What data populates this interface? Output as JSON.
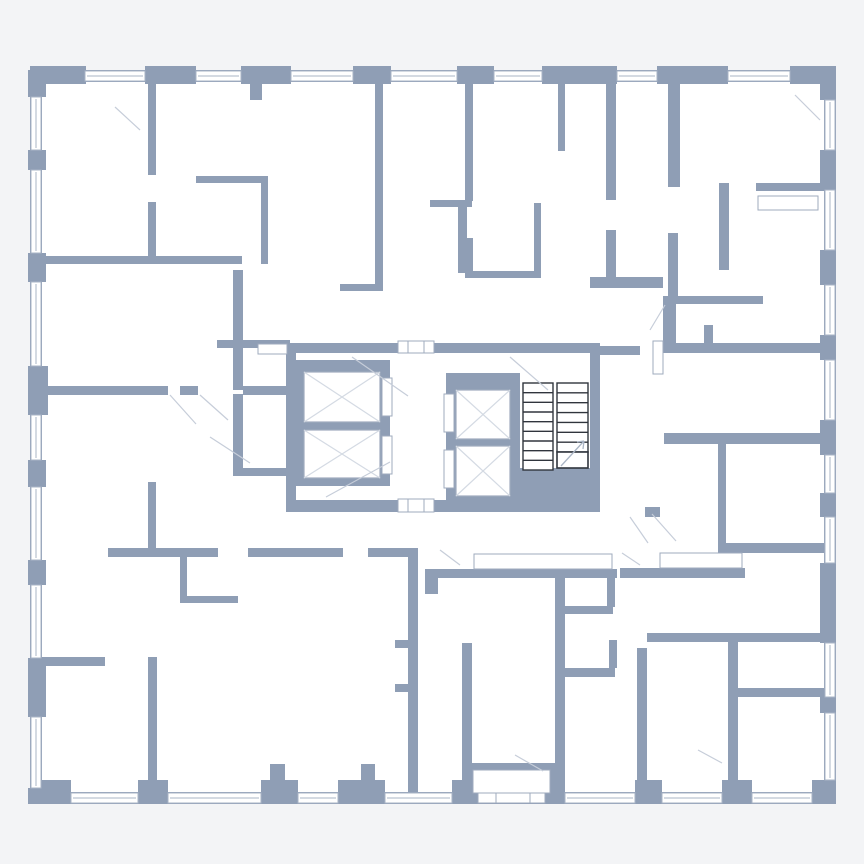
{
  "plan": {
    "canvas": {
      "w": 864,
      "h": 864
    },
    "colors": {
      "background": "#f3f4f6",
      "strip": "#ffffff",
      "wall": "#8f9eb5",
      "floor": "#ffffff",
      "window_line": "#a9b4c6",
      "box_line": "#9fabbe",
      "swing_line": "#c6cdd9",
      "elevator_x_line": "#d4dae3",
      "stair_outline": "#30353d",
      "arrow_line": "#aab5c5"
    },
    "floor": {
      "x": 30,
      "y": 70,
      "w": 806,
      "h": 734
    },
    "walls": [
      [
        "outer-wall-top",
        30,
        70,
        806,
        12
      ],
      [
        "outer-wall-bottom",
        30,
        792,
        806,
        12
      ],
      [
        "outer-wall-left",
        30,
        70,
        12,
        734
      ],
      [
        "outer-wall-right",
        824,
        70,
        12,
        734
      ],
      [
        "pier-top-0",
        30,
        66,
        56,
        18
      ],
      [
        "pier-top-1",
        145,
        66,
        51,
        18
      ],
      [
        "pier-top-2",
        241,
        66,
        50,
        18
      ],
      [
        "pier-top-3",
        353,
        66,
        38,
        18
      ],
      [
        "pier-top-4",
        457,
        66,
        37,
        18
      ],
      [
        "pier-top-5",
        542,
        66,
        75,
        18
      ],
      [
        "pier-top-6",
        657,
        66,
        71,
        18
      ],
      [
        "pier-top-7",
        790,
        66,
        46,
        18
      ],
      [
        "pier-bottom-0",
        30,
        780,
        41,
        24
      ],
      [
        "pier-bottom-1",
        138,
        780,
        30,
        24
      ],
      [
        "pier-bottom-2",
        261,
        780,
        37,
        24
      ],
      [
        "pier-bottom-3",
        338,
        780,
        47,
        24
      ],
      [
        "pier-bottom-4",
        452,
        780,
        16,
        24
      ],
      [
        "pier-bottom-5",
        635,
        780,
        27,
        24
      ],
      [
        "pier-bottom-6",
        722,
        780,
        30,
        24
      ],
      [
        "pier-bottom-7",
        812,
        780,
        24,
        24
      ],
      [
        "pier-left-0",
        28,
        70,
        18,
        27
      ],
      [
        "pier-left-1",
        28,
        150,
        18,
        20
      ],
      [
        "pier-left-2",
        28,
        253,
        18,
        29
      ],
      [
        "pier-left-3",
        28,
        366,
        20,
        49
      ],
      [
        "pier-left-4",
        28,
        460,
        18,
        27
      ],
      [
        "pier-left-5",
        28,
        560,
        18,
        25
      ],
      [
        "pier-left-6",
        28,
        658,
        18,
        59
      ],
      [
        "pier-left-7",
        28,
        788,
        18,
        16
      ],
      [
        "pier-right-0",
        820,
        70,
        16,
        30
      ],
      [
        "pier-right-1",
        820,
        150,
        16,
        40
      ],
      [
        "pier-right-2",
        820,
        250,
        16,
        35
      ],
      [
        "pier-right-3",
        820,
        335,
        16,
        25
      ],
      [
        "pier-right-4",
        820,
        420,
        16,
        35
      ],
      [
        "pier-right-5",
        820,
        493,
        16,
        24
      ],
      [
        "pier-right-6",
        820,
        563,
        16,
        80
      ],
      [
        "pier-right-7",
        820,
        697,
        16,
        16
      ],
      [
        "pier-right-8",
        820,
        780,
        16,
        24
      ],
      [
        "core-wall-top-left",
        286,
        343,
        112,
        10
      ],
      [
        "core-wall-top-right",
        434,
        343,
        166,
        10
      ],
      [
        "core-wall-left",
        286,
        343,
        10,
        169
      ],
      [
        "core-wall-right",
        590,
        343,
        10,
        169
      ],
      [
        "core-wall-bottom-left",
        286,
        500,
        112,
        12
      ],
      [
        "core-wall-bottom-right",
        434,
        500,
        166,
        12
      ],
      [
        "elevator-shaft-left",
        294,
        360,
        96,
        126
      ],
      [
        "elevator-shaft-small",
        446,
        373,
        74,
        131
      ],
      [
        "stair-landing",
        520,
        468,
        80,
        44
      ],
      [
        "wall-a1",
        148,
        83,
        8,
        92
      ],
      [
        "wall-a2",
        148,
        202,
        8,
        62
      ],
      [
        "wall-a3",
        42,
        256,
        200,
        8
      ],
      [
        "wall-a4",
        196,
        176,
        72,
        7
      ],
      [
        "wall-a5",
        261,
        176,
        7,
        88
      ],
      [
        "wall-a6",
        375,
        83,
        8,
        207
      ],
      [
        "wall-a7",
        340,
        284,
        43,
        7
      ],
      [
        "wall-b1",
        465,
        83,
        8,
        118
      ],
      [
        "wall-b2",
        465,
        238,
        8,
        40
      ],
      [
        "wall-b3",
        430,
        200,
        42,
        7
      ],
      [
        "wall-b4",
        458,
        207,
        9,
        66
      ],
      [
        "wall-b5",
        465,
        271,
        76,
        7
      ],
      [
        "wall-b6",
        534,
        203,
        7,
        75
      ],
      [
        "wall-b7",
        558,
        83,
        7,
        68
      ],
      [
        "wall-c1",
        606,
        80,
        10,
        120
      ],
      [
        "wall-c2",
        606,
        230,
        10,
        47
      ],
      [
        "wall-c3",
        590,
        277,
        73,
        11
      ],
      [
        "wall-c4",
        668,
        83,
        12,
        104
      ],
      [
        "wall-c5",
        756,
        183,
        68,
        8
      ],
      [
        "wall-c6",
        719,
        183,
        10,
        87
      ],
      [
        "wall-c7",
        668,
        233,
        10,
        70
      ],
      [
        "wall-c8",
        663,
        296,
        13,
        54
      ],
      [
        "wall-c9",
        663,
        296,
        100,
        8
      ],
      [
        "wall-d1",
        600,
        346,
        40,
        9
      ],
      [
        "wall-d2",
        663,
        343,
        161,
        10
      ],
      [
        "wall-d3",
        704,
        325,
        9,
        20
      ],
      [
        "wall-d4",
        664,
        433,
        160,
        11
      ],
      [
        "wall-d5",
        718,
        444,
        8,
        99
      ],
      [
        "wall-d6",
        718,
        543,
        106,
        10
      ],
      [
        "wall-d7",
        620,
        568,
        125,
        10
      ],
      [
        "wall-d8",
        647,
        633,
        177,
        9
      ],
      [
        "wall-d9",
        637,
        648,
        10,
        145
      ],
      [
        "wall-d10",
        728,
        642,
        10,
        151
      ],
      [
        "wall-d11",
        732,
        688,
        92,
        9
      ],
      [
        "wall-e1",
        42,
        386,
        126,
        9
      ],
      [
        "wall-e2",
        180,
        386,
        18,
        9
      ],
      [
        "wall-e3",
        243,
        386,
        45,
        9
      ],
      [
        "wall-e4",
        217,
        340,
        73,
        8
      ],
      [
        "wall-e5",
        233,
        270,
        10,
        120
      ],
      [
        "wall-e6",
        233,
        394,
        10,
        74
      ],
      [
        "wall-e7",
        233,
        468,
        70,
        8
      ],
      [
        "wall-f1",
        42,
        657,
        63,
        9
      ],
      [
        "wall-f2",
        148,
        657,
        9,
        135
      ],
      [
        "wall-f3",
        148,
        482,
        8,
        66
      ],
      [
        "wall-f4",
        180,
        557,
        7,
        46
      ],
      [
        "wall-f5",
        180,
        596,
        58,
        7
      ],
      [
        "wall-g1",
        108,
        548,
        110,
        9
      ],
      [
        "wall-g2",
        248,
        548,
        95,
        9
      ],
      [
        "wall-g3",
        368,
        548,
        40,
        9
      ],
      [
        "wall-g4",
        408,
        548,
        10,
        245
      ],
      [
        "wall-g5",
        425,
        569,
        192,
        9
      ],
      [
        "wall-g6",
        425,
        569,
        13,
        25
      ],
      [
        "wall-g7",
        462,
        643,
        10,
        150
      ],
      [
        "wall-g8",
        555,
        577,
        10,
        216
      ],
      [
        "wall-h1",
        560,
        606,
        53,
        8
      ],
      [
        "wall-h2",
        607,
        577,
        8,
        30
      ],
      [
        "wall-h3",
        560,
        668,
        55,
        9
      ],
      [
        "wall-h4",
        609,
        640,
        8,
        28
      ],
      [
        "wall-h5",
        395,
        640,
        22,
        8
      ],
      [
        "wall-h6",
        395,
        684,
        22,
        8
      ],
      [
        "wall-h7",
        645,
        507,
        15,
        10
      ],
      [
        "wall-h8",
        250,
        82,
        12,
        18
      ],
      [
        "wall-h9",
        270,
        764,
        15,
        28
      ],
      [
        "wall-h10",
        361,
        764,
        14,
        28
      ],
      [
        "vestibule-frame",
        468,
        763,
        87,
        32
      ]
    ],
    "windows": {
      "top": [
        [
          85,
          145
        ],
        [
          196,
          241
        ],
        [
          291,
          353
        ],
        [
          391,
          457
        ],
        [
          494,
          542
        ],
        [
          617,
          657
        ],
        [
          728,
          790
        ]
      ],
      "bottom": [
        [
          71,
          138
        ],
        [
          168,
          261
        ],
        [
          298,
          338
        ],
        [
          385,
          452
        ],
        [
          565,
          635
        ],
        [
          662,
          722
        ],
        [
          752,
          812
        ]
      ],
      "left": [
        [
          97,
          150
        ],
        [
          170,
          253
        ],
        [
          282,
          366
        ],
        [
          415,
          460
        ],
        [
          487,
          560
        ],
        [
          585,
          658
        ],
        [
          717,
          788
        ]
      ],
      "right": [
        [
          100,
          150
        ],
        [
          190,
          250
        ],
        [
          285,
          335
        ],
        [
          360,
          420
        ],
        [
          455,
          493
        ],
        [
          517,
          563
        ],
        [
          643,
          697
        ],
        [
          713,
          780
        ]
      ]
    },
    "white_boxes": [
      [
        "vestibule-inner",
        473,
        770,
        77,
        23
      ],
      [
        "entrance-door-opening",
        478,
        793,
        67,
        10
      ],
      [
        "lobby-door-top",
        398,
        341,
        36,
        12
      ],
      [
        "lobby-door-bottom",
        398,
        499,
        36,
        13
      ],
      [
        "builtin-box-1",
        474,
        554,
        138,
        15
      ],
      [
        "builtin-box-2",
        660,
        553,
        82,
        15
      ],
      [
        "builtin-box-3",
        758,
        196,
        60,
        14
      ],
      [
        "builtin-box-4",
        258,
        344,
        29,
        10
      ],
      [
        "door-leaf-1",
        653,
        341,
        10,
        33
      ],
      [
        "elevator-door-1",
        382,
        378,
        10,
        38
      ],
      [
        "elevator-door-2",
        382,
        436,
        10,
        38
      ],
      [
        "elevator-door-3",
        444,
        394,
        10,
        38
      ],
      [
        "elevator-door-4",
        444,
        450,
        10,
        38
      ]
    ],
    "elevators": [
      [
        "elevator-car-1",
        304,
        372,
        76,
        50
      ],
      [
        "elevator-car-2",
        304,
        430,
        76,
        48
      ],
      [
        "elevator-car-3",
        456,
        390,
        54,
        49
      ],
      [
        "elevator-car-4",
        456,
        446,
        54,
        50
      ]
    ],
    "stairs": {
      "flights": [
        {
          "name": "stair-flight-left",
          "x": 523,
          "y": 383,
          "w": 30,
          "h": 87,
          "treads": 9
        },
        {
          "name": "stair-flight-right",
          "x": 557,
          "y": 383,
          "w": 31,
          "h": 69,
          "treads": 7
        }
      ],
      "last_tread": [
        557,
        452,
        31,
        16
      ],
      "arrow": [
        561,
        466,
        584,
        441
      ]
    },
    "swings": [
      [
        115,
        107,
        140,
        130
      ],
      [
        170,
        395,
        196,
        424
      ],
      [
        200,
        395,
        228,
        420
      ],
      [
        352,
        357,
        408,
        396
      ],
      [
        510,
        357,
        548,
        390
      ],
      [
        326,
        497,
        390,
        462
      ],
      [
        630,
        517,
        648,
        543
      ],
      [
        652,
        514,
        676,
        541
      ],
      [
        698,
        750,
        722,
        763
      ],
      [
        515,
        755,
        543,
        771
      ],
      [
        795,
        95,
        820,
        120
      ],
      [
        665,
        305,
        650,
        330
      ],
      [
        210,
        437,
        250,
        463
      ],
      [
        622,
        553,
        640,
        565
      ],
      [
        440,
        550,
        460,
        565
      ]
    ],
    "ticks": [
      [
        408,
        341,
        408,
        353
      ],
      [
        424,
        341,
        424,
        353
      ],
      [
        408,
        499,
        408,
        512
      ],
      [
        424,
        499,
        424,
        512
      ],
      [
        496,
        793,
        496,
        803
      ],
      [
        530,
        793,
        530,
        803
      ]
    ]
  }
}
